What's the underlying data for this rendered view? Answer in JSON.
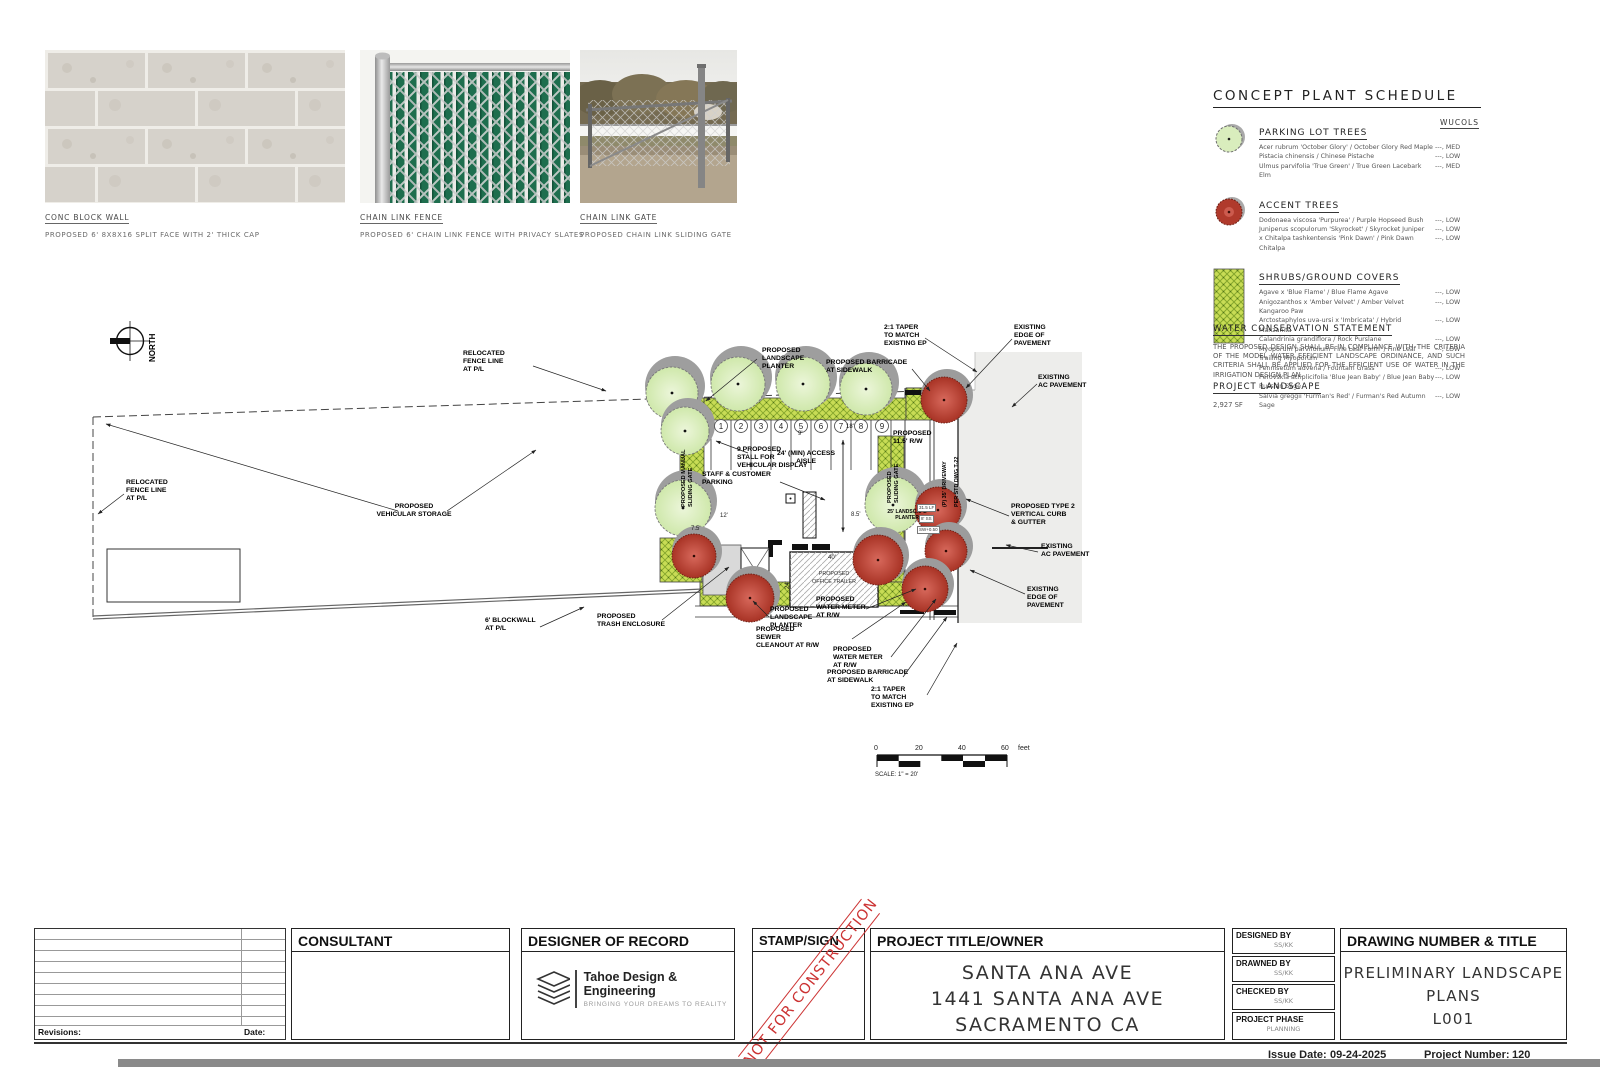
{
  "photos": [
    {
      "title": "CONC BLOCK WALL",
      "caption": "PROPOSED 6' 8X8X16 SPLIT FACE WITH 2' THICK CAP"
    },
    {
      "title": "CHAIN LINK FENCE",
      "caption": "PROPOSED 6' CHAIN LINK FENCE WITH PRIVACY SLATES"
    },
    {
      "title": "CHAIN LINK GATE",
      "caption": "PROPOSED CHAIN LINK SLIDING GATE"
    }
  ],
  "plant_schedule": {
    "title": "CONCEPT PLANT SCHEDULE",
    "wucols_header": "WUCOLS",
    "sections": [
      {
        "heading": "PARKING LOT TREES",
        "rows": [
          {
            "name": "Acer rubrum 'October Glory' / October Glory Red Maple",
            "wucols": "---, MED"
          },
          {
            "name": "Pistacia chinensis / Chinese Pistache",
            "wucols": "---, LOW"
          },
          {
            "name": "Ulmus parvifolia 'True Green' / True Green Lacebark Elm",
            "wucols": "---, MED"
          }
        ]
      },
      {
        "heading": "ACCENT TREES",
        "rows": [
          {
            "name": "Dodonaea viscosa 'Purpurea' / Purple Hopseed Bush",
            "wucols": "---, LOW"
          },
          {
            "name": "Juniperus scopulorum 'Skyrocket' / Skyrocket Juniper",
            "wucols": "---, LOW"
          },
          {
            "name": "x Chitalpa tashkentensis 'Pink Dawn' / Pink Dawn Chitalpa",
            "wucols": "---, LOW"
          }
        ]
      },
      {
        "heading": "SHRUBS/GROUND COVERS",
        "rows": [
          {
            "name": "Agave x 'Blue Flame' / Blue Flame Agave",
            "wucols": "---, LOW"
          },
          {
            "name": "Anigozanthos x 'Amber Velvet' / Amber Velvet Kangaroo Paw",
            "wucols": "---, LOW"
          },
          {
            "name": "Arctostaphylos uva-ursi x 'Imbricata' / Hybrid Manzanita",
            "wucols": "---, LOW"
          },
          {
            "name": "Calandrinia grandiflora / Rock Purslane",
            "wucols": "---, LOW"
          },
          {
            "name": "Myoporum parvifolium 'Fine Leaf Form' / Fine Leaf Trailing Myoporum",
            "wucols": "---, LOW"
          },
          {
            "name": "Pennisetum advena / Fountain Grass",
            "wucols": "---, LOW"
          },
          {
            "name": "Perovskia atriplicifolia 'Blue Jean Baby' / Blue Jean Baby Russian Sage",
            "wucols": "---, LOW"
          },
          {
            "name": "Salvia greggii 'Furman's Red' / Furman's Red Autumn Sage",
            "wucols": "---, LOW"
          }
        ]
      }
    ]
  },
  "water_statement": {
    "title": "WATER CONSERVATION STATEMENT",
    "body": "THE PROPOSED DESIGN SHALL BE IN COMPLIANCE WITH THE CRITERIA OF THE MODEL WATER EFFICIENT LANDSCAPE ORDINANCE, AND SUCH CRITERIA SHALL BE APPLIED FOR THE EFFICIENT USE OF WATER IN THE IRRIGATION DESIGN PLAN."
  },
  "project_landscape": {
    "title": "PROJECT LANDSCAPE",
    "value": "2,927 SF"
  },
  "site_plan": {
    "north_label": "NORTH",
    "stalls": [
      "1",
      "2",
      "3",
      "4",
      "5",
      "6",
      "7",
      "8",
      "9"
    ],
    "annotations": [
      "RELOCATED\nFENCE LINE\nAT P/L",
      "RELOCATED\nFENCE LINE\nAT P/L",
      "PROPOSED\nVEHICULAR STORAGE",
      "6' BLOCKWALL\nAT P/L",
      "PROPOSED\nTRASH ENCLOSURE",
      "PROPOSED\nLANDSCAPE\nPLANTER",
      "PROPOSED BARRICADE\nAT SIDEWALK",
      "2:1 TAPER\nTO MATCH\nEXISTING EP",
      "EXISTING\nEDGE OF\nPAVEMENT",
      "EXISTING\nAC PAVEMENT",
      "9 PROPOSED\nSTALL FOR\nVEHICULAR DISPLAY",
      "24' (MIN) ACCESS\nAISLE",
      "PROPOSED\n11.5' R/W",
      "STAFF & CUSTOMER\nPARKING",
      "PROPOSED TYPE 2\nVERTICAL CURB\n& GUTTER",
      "EXISTING\nAC PAVEMENT",
      "EXISTING\nEDGE OF\nPAVEMENT",
      "PROPOSED\nLANDSCAPE\nPLANTER",
      "PROPOSED\nWATER METER\nAT R/W",
      "PROPOSED\nSEWER\nCLEANOUT AT R/W",
      "PROPOSED\nWATER METER\nAT R/W",
      "PROPOSED BARRICADE\nAT SIDEWALK",
      "2:1 TAPER\nTO MATCH\nEXISTING EP",
      "PROPOSED\nOFFICE TRAILER",
      "PROPOSED MANUAL\nSLIDING GATE",
      "PROPOSED\nSLIDING GATE",
      "(P) 35' DRIVEWAY",
      "PER STD DWG T-22",
      "25' LANDSCAPE\nPLANTER"
    ],
    "dims": {
      "d9": "9'",
      "d18": "18'",
      "d12": "12'",
      "d85": "8.5'",
      "d75": "7.5'",
      "d40": "40'",
      "d24": "24'"
    },
    "micro_labels": [
      "31.5 LF",
      "8' SS",
      "SW+0.50"
    ],
    "scale_bar": {
      "t0": "0",
      "t1": "20",
      "t2": "40",
      "t3": "60",
      "unit": "feet",
      "caption": "SCALE: 1\" = 20'"
    }
  },
  "title_block": {
    "revisions_label": "Revisions:",
    "date_label": "Date:",
    "consultant_header": "CONSULTANT",
    "designer_header": "DESIGNER OF RECORD",
    "logo_name": "Tahoe Design & Engineering",
    "logo_tagline": "BRINGING YOUR DREAMS TO REALITY",
    "stamp_header": "STAMP/SIGN",
    "stamp_watermark": "NOT FOR CONSTRUCTION",
    "project_header": "PROJECT TITLE/OWNER",
    "project_lines": [
      "SANTA ANA AVE",
      "1441 SANTA ANA AVE",
      "SACRAMENTO CA"
    ],
    "meta": [
      {
        "label": "DESIGNED BY",
        "value": "SS/KK"
      },
      {
        "label": "DRAWNED BY",
        "value": "SS/KK"
      },
      {
        "label": "CHECKED BY",
        "value": "SS/KK"
      },
      {
        "label": "PROJECT PHASE",
        "value": "PLANNING"
      }
    ],
    "drawing_header": "DRAWING NUMBER & TITLE",
    "drawing_lines": [
      "PRELIMINARY LANDSCAPE",
      "PLANS",
      "L001"
    ]
  },
  "footer": {
    "issue_label": "Issue Date:",
    "issue_value": "09-24-2025",
    "number_label": "Project Number:",
    "number_value": "120"
  },
  "colors": {
    "accent_red": "#b03a2c",
    "tree_green": "#d9edbd",
    "shrub_lime": "#c8dc55",
    "stamp_red": "#cc3333"
  }
}
